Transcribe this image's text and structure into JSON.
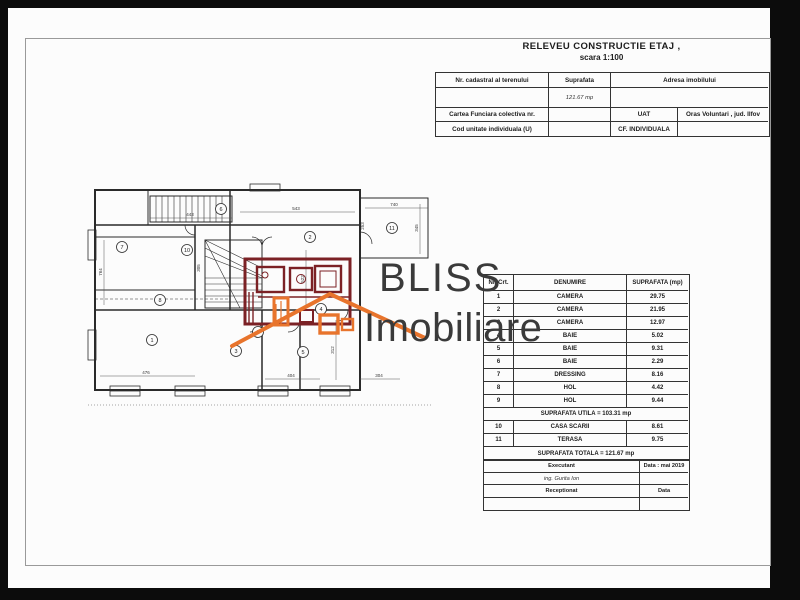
{
  "doc": {
    "title_line1": "RELEVEU CONSTRUCTIE  ETAJ ,",
    "title_line2": "scara 1:100"
  },
  "cadastral_table": {
    "col_nr_cadastral": "Nr. cadastral al terenului",
    "col_suprafata": "Suprafata",
    "col_adresa": "Adresa imobilului",
    "suprafata_value": "121.67 mp",
    "cartea_funciara": "Cartea Funciara colectiva nr.",
    "uat_label": "UAT",
    "uat_value": "Oras Voluntari , jud. Ilfov",
    "cod_unitate": "Cod unitate individuala (U)",
    "cf_individuala": "CF. INDIVIDUALA"
  },
  "rooms_table": {
    "headers": {
      "nr": "Nr. Crt.",
      "name": "DENUMIRE",
      "area": "SUPRAFATA (mp)"
    },
    "rows": [
      {
        "nr": "1",
        "name": "CAMERA",
        "area": "29.75"
      },
      {
        "nr": "2",
        "name": "CAMERA",
        "area": "21.95"
      },
      {
        "nr": "3",
        "name": "CAMERA",
        "area": "12.97"
      },
      {
        "nr": "4",
        "name": "BAIE",
        "area": "5.02"
      },
      {
        "nr": "5",
        "name": "BAIE",
        "area": "9.31"
      },
      {
        "nr": "6",
        "name": "BAIE",
        "area": "2.29"
      },
      {
        "nr": "7",
        "name": "DRESSING",
        "area": "8.16"
      },
      {
        "nr": "8",
        "name": "HOL",
        "area": "4.42"
      },
      {
        "nr": "9",
        "name": "HOL",
        "area": "9.44"
      },
      {
        "nr": "10",
        "name": "CASA  SCARII",
        "area": "8.61"
      },
      {
        "nr": "11",
        "name": "TERASA",
        "area": "9.75"
      }
    ],
    "utila_row": "SUPRAFATA UTILA = 103.31 mp",
    "totala_row": "SUPRAFATA TOTALA = 121.67 mp"
  },
  "signature_table": {
    "executant_label": "Executant",
    "executant_data": "Data : mai 2019",
    "executant_name": "ing. Gurita Ion",
    "receptionat_label": "Receptionat",
    "receptionat_data": "Data"
  },
  "logo": {
    "line1": "BLISS",
    "line2": "Imobiliare",
    "text_color": "#3a3a3a",
    "house_color": "#e8742c"
  },
  "plan": {
    "highlight_color": "#7b2125",
    "room_numbers": [
      "1",
      "2",
      "3",
      "4",
      "5",
      "6",
      "7",
      "8",
      "9",
      "10",
      "11"
    ],
    "dims": [
      {
        "t": "443"
      },
      {
        "t": "543"
      },
      {
        "t": "740"
      },
      {
        "t": "476"
      },
      {
        "t": "404"
      },
      {
        "t": "304"
      },
      {
        "t": "764"
      },
      {
        "t": "522"
      },
      {
        "t": "312"
      },
      {
        "t": "305"
      },
      {
        "t": "253"
      },
      {
        "t": "345"
      }
    ]
  }
}
